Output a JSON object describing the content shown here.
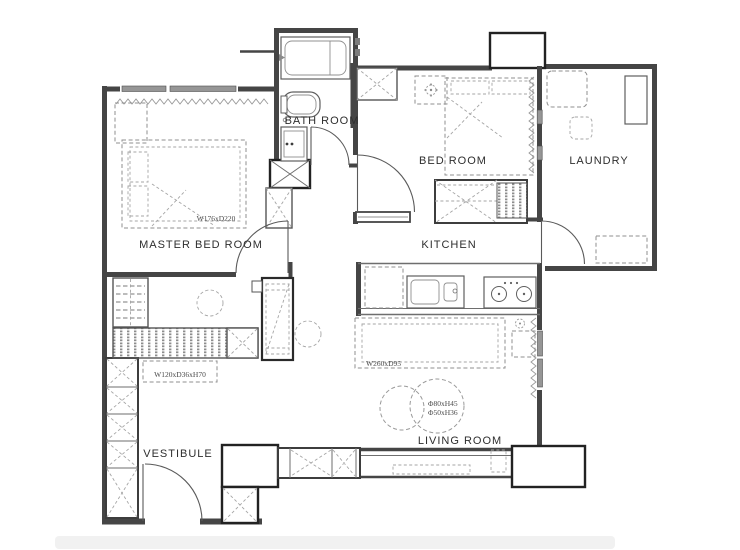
{
  "colors": {
    "background": "#ffffff",
    "wall": "#454545",
    "bold_outline": "#222222",
    "furniture_dash": "#8f8f8f",
    "window_fill": "#969696",
    "label_text": "#2e2e2e"
  },
  "rooms": {
    "master_bedroom": {
      "label": "MASTER BED ROOM",
      "bed_dim": "W176xD220"
    },
    "bath_room": {
      "label": "BATH ROOM"
    },
    "bed_room": {
      "label": "BED ROOM"
    },
    "laundry": {
      "label": "LAUNDRY"
    },
    "kitchen": {
      "label": "KITCHEN"
    },
    "living_room": {
      "label": "LIVING ROOM",
      "sofa_dim": "W260xD95",
      "table_dim_1": "Φ80xH45",
      "table_dim_2": "Φ50xH36"
    },
    "vestibule": {
      "label": "VESTIBULE",
      "cabinet_dim": "W120xD36xH70"
    }
  }
}
